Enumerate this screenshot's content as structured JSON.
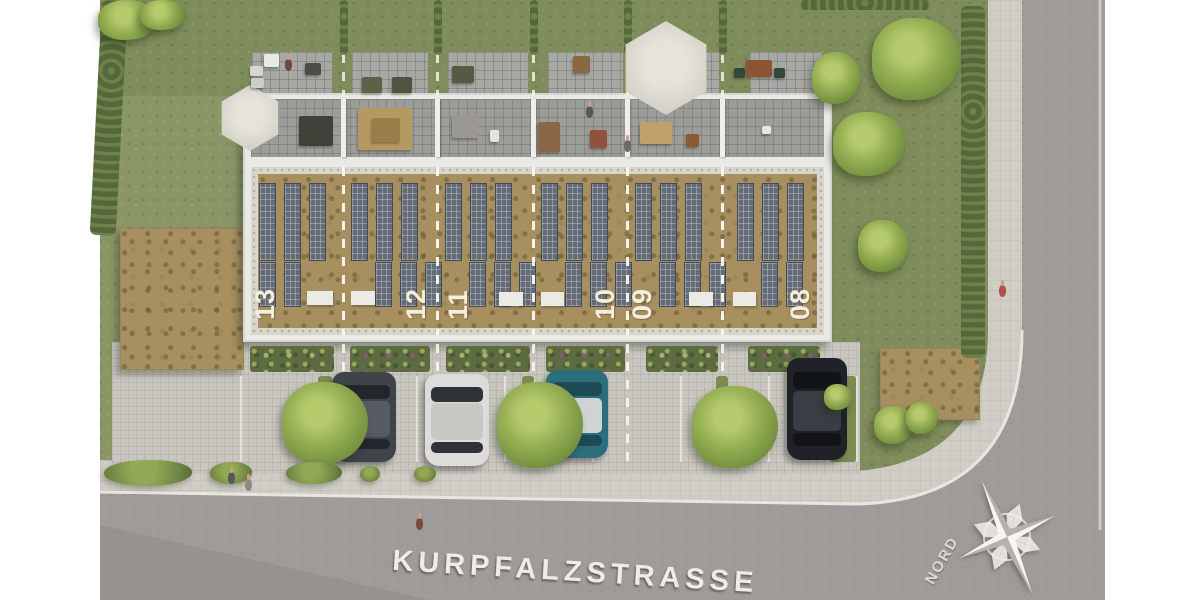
{
  "labels": {
    "street_name": "KURPFALZSTRASSE",
    "compass_north": "NORD"
  },
  "building": {
    "units": [
      {
        "number": "13"
      },
      {
        "number": "12"
      },
      {
        "number": "11"
      },
      {
        "number": "10"
      },
      {
        "number": "09"
      },
      {
        "number": "08"
      }
    ]
  },
  "colors": {
    "grass": "#8a9666",
    "back_garden_grass": "#7f8c5b",
    "sedum_roof": "#a88f60",
    "solar_panel": "#636b76",
    "building_wall_white": "#e9e9e6",
    "terrace_pavement": "#9c9c99",
    "walkway_paver": "#c9c6bf",
    "asphalt_road": "#9e9b98",
    "sidewalk_paver": "#d0cdc5",
    "tree_green": "#93ad52",
    "marking_white": "#efece7"
  }
}
